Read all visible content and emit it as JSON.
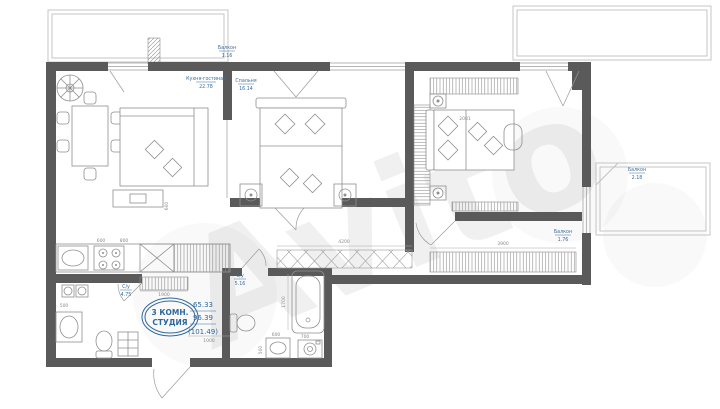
{
  "watermark": "Avito",
  "stamp": {
    "type_line1": "3 КОМН.",
    "type_line2": "СТУДИЯ",
    "living_area": "65.33",
    "total_area": "96.39",
    "extended_area": "(101.49)"
  },
  "labels": {
    "kitchen_living": {
      "name": "Кухня-гостиная",
      "area": "22.78"
    },
    "bedroom": {
      "name": "Спальня",
      "area": "16.14"
    },
    "bathroom_left": {
      "name": "С/у",
      "area": "4.75"
    },
    "bathroom_main": {
      "name": "С/у",
      "area": "5.16"
    },
    "balcony_top": {
      "name": "Балкон",
      "area": "1.16"
    },
    "balcony_right": {
      "name": "Балкон",
      "area": "2.18"
    },
    "balcony_window": {
      "name": "Балкон",
      "area": "1.76"
    }
  },
  "dimensions": {
    "d1900": "1900",
    "d1000": "1000",
    "d4200": "4200",
    "d3900": "3900",
    "d1700": "1700",
    "d600a": "600",
    "d700": "700",
    "d500a": "500",
    "d500b": "500",
    "d2081": "2081",
    "d600b": "600",
    "d800": "800",
    "d600c": "600"
  },
  "colors": {
    "wall": "#5a5a5a",
    "label_blue": "#3a6d9d",
    "dim_gray": "#8a8a8a"
  }
}
